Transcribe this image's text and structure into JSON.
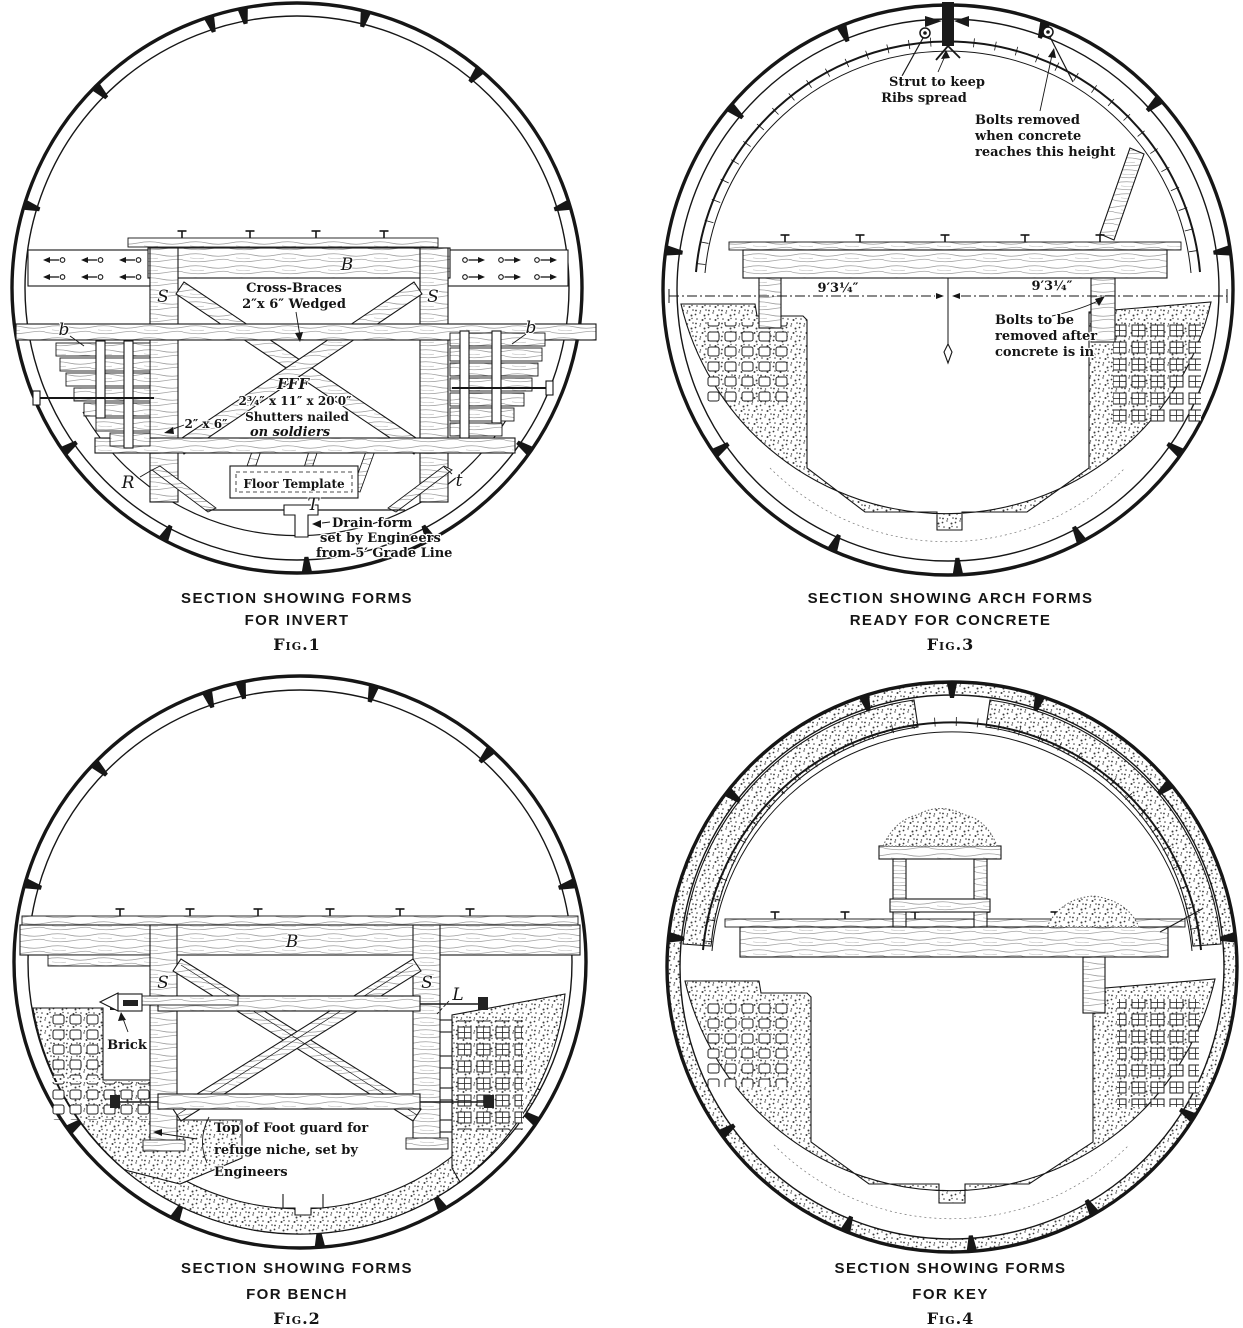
{
  "figures": {
    "fig1": {
      "caption": [
        "SECTION SHOWING FORMS",
        "FOR INVERT"
      ],
      "fig_label": "Fig.1",
      "labels": {
        "beam": "B",
        "soldier_left": "S",
        "soldier_right": "S",
        "shutter_left": "b",
        "shutter_right": "b",
        "cross_braces_1": "Cross-Braces",
        "cross_braces_2": "2″x 6″ Wedged",
        "fff": "FFF",
        "fff_dims": "2¾″ x 11″ x 20′0″",
        "shutters_1": "Shutters nailed",
        "shutters_2": "on soldiers",
        "stud_size": "2″ x 6″",
        "rib": "R",
        "floor_template": "Floor Template",
        "template_t": "T",
        "t_small": "t",
        "drain_1": "Drain form",
        "drain_2": "set by Engineers",
        "drain_3": "from 5′ Grade Line"
      }
    },
    "fig3": {
      "caption": [
        "SECTION SHOWING ARCH FORMS",
        "READY FOR CONCRETE"
      ],
      "fig_label": "Fig.3",
      "labels": {
        "strut_1": "Strut to keep",
        "strut_2": "Ribs spread",
        "bolts_removed_1": "Bolts removed",
        "bolts_removed_2": "when concrete",
        "bolts_removed_3": "reaches this height",
        "dim_left": "9′3¼″",
        "dim_right": "9′3¼″",
        "bolts_after_1": "Bolts to be",
        "bolts_after_2": "removed after",
        "bolts_after_3": "concrete is in"
      }
    },
    "fig2": {
      "caption": [
        "SECTION SHOWING FORMS",
        "FOR BENCH"
      ],
      "fig_label": "Fig.2",
      "labels": {
        "beam": "B",
        "soldier_left": "S",
        "soldier_right": "S",
        "lagging": "L",
        "brick": "Brick",
        "footguard_1": "Top of Foot guard for",
        "footguard_2": "refuge niche, set by",
        "footguard_3": "Engineers"
      }
    },
    "fig4": {
      "caption": [
        "SECTION SHOWING FORMS",
        "FOR KEY"
      ],
      "fig_label": "Fig.4"
    }
  }
}
